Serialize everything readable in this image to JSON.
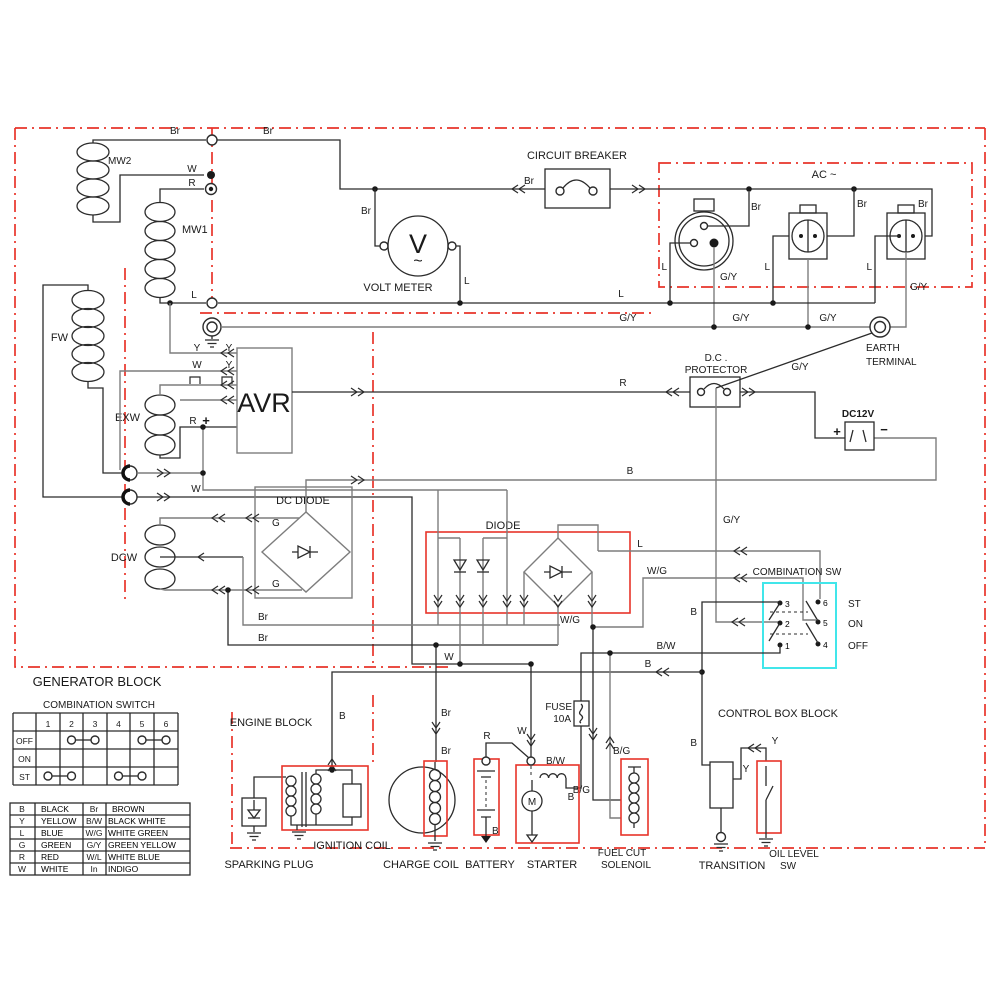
{
  "blocks": {
    "generator_block": "GENERATOR BLOCK",
    "engine_block": "ENGINE BLOCK",
    "control_box_block": "CONTROL BOX BLOCK",
    "ac_block": "AC ~"
  },
  "components": {
    "circuit_breaker": "CIRCUIT BREAKER",
    "volt_meter": "VOLT METER",
    "volt_meter_symbol": "V",
    "volt_meter_wave": "~",
    "avr": "AVR",
    "dc_diode": "DC DIODE",
    "diode": "DIODE",
    "dc_protector_line1": "D.C .",
    "dc_protector_line2": "PROTECTOR",
    "earth_terminal_line1": "EARTH",
    "earth_terminal_line2": "TERMINAL",
    "dc12v": "DC12V",
    "combination_sw": "COMBINATION SW",
    "sparking_plug": "SPARKING PLUG",
    "ignition_coil": "IGNITION COIL",
    "charge_coil": "CHARGE COIL",
    "battery": "BATTERY",
    "starter": "STARTER",
    "starter_motor": "M",
    "fuse_line1": "FUSE",
    "fuse_line2": "10A",
    "fuel_cut_line1": "FUEL CUT",
    "fuel_cut_line2": "SOLENOIL",
    "transition": "TRANSITION",
    "oil_level_line1": "OIL LEVEL",
    "oil_level_line2": "SW"
  },
  "coils": {
    "mw2": "MW2",
    "mw1": "MW1",
    "fw": "FW",
    "exw": "EXW",
    "dcw": "DCW"
  },
  "wire_labels": {
    "br": "Br",
    "w": "W",
    "r": "R",
    "l": "L",
    "b": "B",
    "y": "Y",
    "g": "G",
    "gy": "G/Y",
    "bw": "B/W",
    "wg": "W/G",
    "bg": "B/G",
    "plus": "+",
    "minus": "−"
  },
  "combination_sw_panel": {
    "positions": {
      "st": "ST",
      "on": "ON",
      "off": "OFF"
    },
    "terminals": {
      "t1": "1",
      "t2": "2",
      "t3": "3",
      "t4": "4",
      "t5": "5",
      "t6": "6"
    }
  },
  "combination_switch_table": {
    "title": "COMBINATION SWITCH",
    "columns": [
      "1",
      "2",
      "3",
      "4",
      "5",
      "6"
    ],
    "rows": [
      {
        "label": "OFF",
        "connections": [
          [
            2,
            3
          ],
          [
            5,
            6
          ]
        ]
      },
      {
        "label": "ON",
        "connections": []
      },
      {
        "label": "ST",
        "connections": [
          [
            1,
            2
          ],
          [
            4,
            5
          ]
        ]
      }
    ]
  },
  "color_legend": {
    "rows": [
      {
        "code1": "B",
        "name1": "BLACK",
        "code2": "Br",
        "name2": "BROWN"
      },
      {
        "code1": "Y",
        "name1": "YELLOW",
        "code2": "B/W",
        "name2": "BLACK WHITE"
      },
      {
        "code1": "L",
        "name1": "BLUE",
        "code2": "W/G",
        "name2": "WHITE GREEN"
      },
      {
        "code1": "G",
        "name1": "GREEN",
        "code2": "G/Y",
        "name2": "GREEN YELLOW"
      },
      {
        "code1": "R",
        "name1": "RED",
        "code2": "W/L",
        "name2": "WHITE BLUE"
      },
      {
        "code1": "W",
        "name1": "WHITE",
        "code2": "In",
        "name2": "INDIGO"
      }
    ]
  },
  "colors": {
    "boundary_red": "#e8342a",
    "component_red": "#e8342a",
    "combination_cyan": "#41e6ea",
    "wire_black": "#2b2b2b",
    "wire_gray": "#7d7d7d"
  }
}
